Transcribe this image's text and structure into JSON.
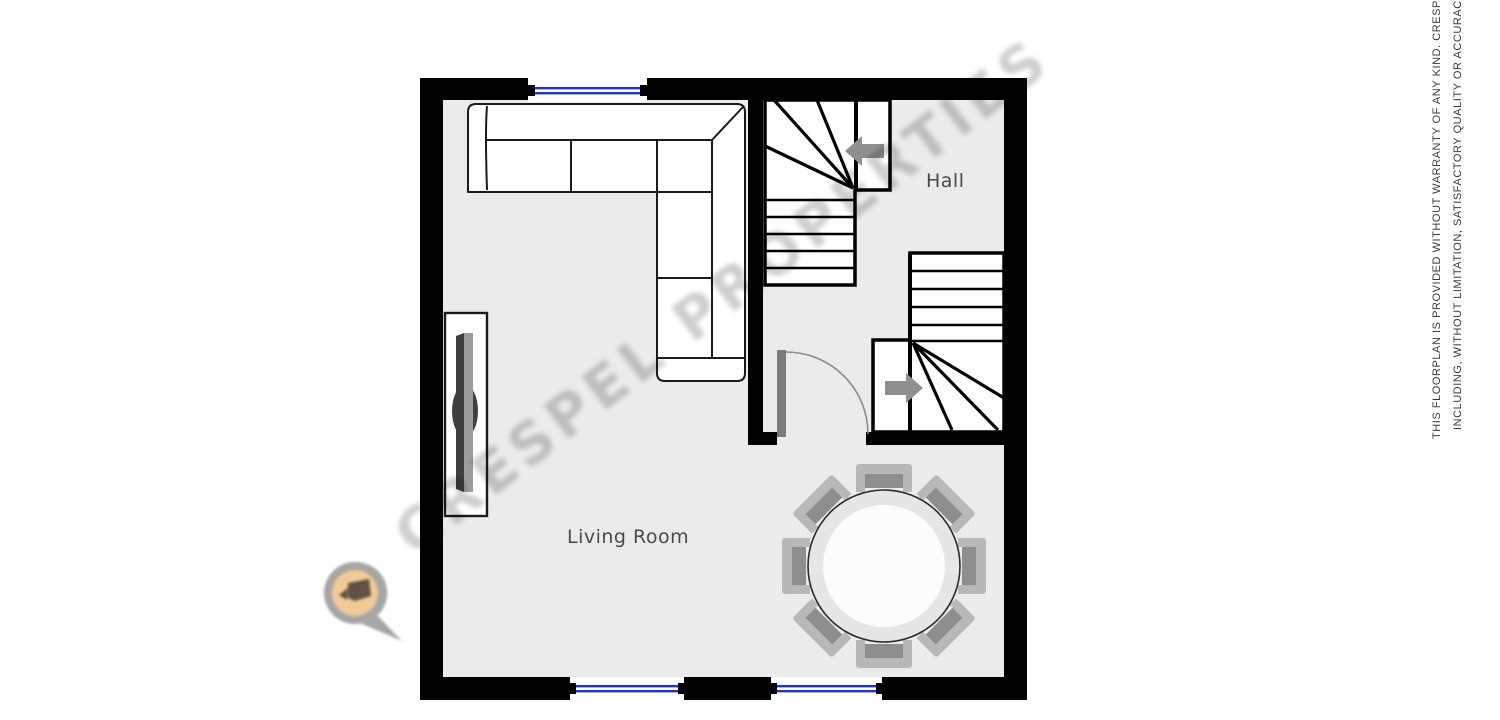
{
  "floorplan": {
    "labels": {
      "living_room": "Living Room",
      "hall": "Hall"
    },
    "watermark_text": "CRESPEL PROPERTIES",
    "disclaimer": {
      "line1": "THIS FLOORPLAN IS PROVIDED WITHOUT WARRANTY OF ANY KIND. CRESPEL PROPER",
      "line2": "INCLUDING, WITHOUT LIMITATION, SATISFACTORY QUALITY OR ACCURACY OF DIM"
    },
    "colors": {
      "wall": "#000000",
      "floor": "#ebebeb",
      "stair_fill": "#ffffff",
      "window_blue": "#2233cc",
      "arrow_gray": "#8f8f8f",
      "door_gray": "#7a7a7a",
      "label_gray": "#4a4a4a",
      "watermark_gray": "#8d8d8d",
      "logo_pin_gray": "#9a9a9a",
      "logo_badge_orange": "#f0c389"
    },
    "furniture": [
      "corner-sofa",
      "tv-unit",
      "round-dining-table",
      "8 chairs"
    ],
    "stairs": [
      "upper-winder-staircase",
      "lower-winder-staircase"
    ]
  }
}
